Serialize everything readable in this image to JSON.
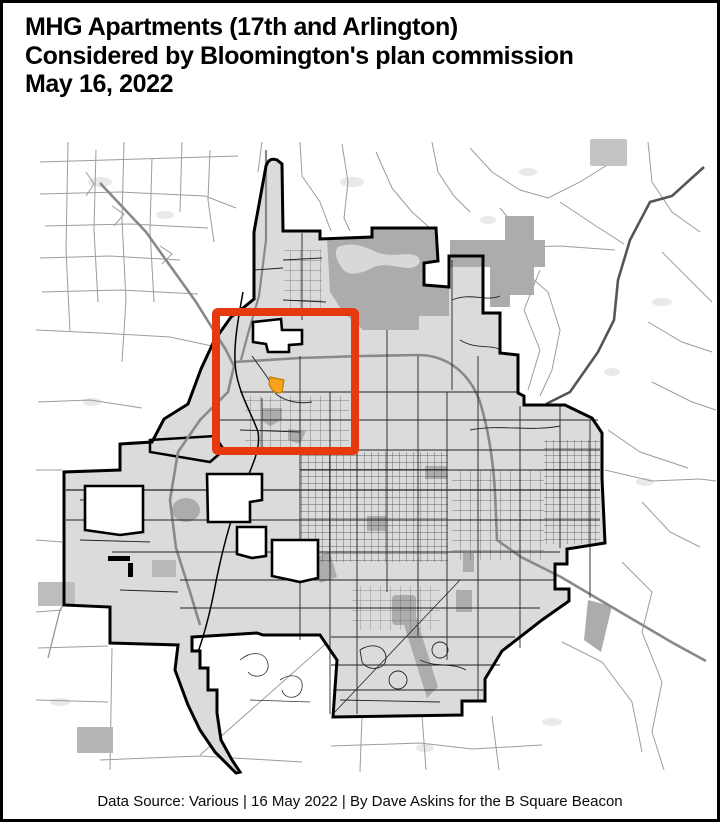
{
  "page": {
    "background_color": "#ffffff",
    "border_color": "#000000"
  },
  "header": {
    "title_lines": [
      "MHG Apartments (17th and Arlington)",
      "Considered by Bloomington's plan commission",
      "May 16, 2022"
    ]
  },
  "map": {
    "colors": {
      "city_fill": "#dbdbdb",
      "city_boundary": "#000000",
      "wooded_area": "#acacac",
      "lake": "#d8d8d8",
      "highway": "#898989",
      "rural_road": "#9c9c9c",
      "city_street": "#222222",
      "highlight_red": "#e8380d",
      "marker_orange": "#f6a21d",
      "marker_outline": "#c07c00"
    },
    "icons": {
      "highlight": "red-rectangle-outline",
      "site_marker": "orange-wedge-marker"
    }
  },
  "footer": {
    "caption": "Data Source: Various | 16 May 2022 | By Dave Askins for the B Square Beacon"
  }
}
